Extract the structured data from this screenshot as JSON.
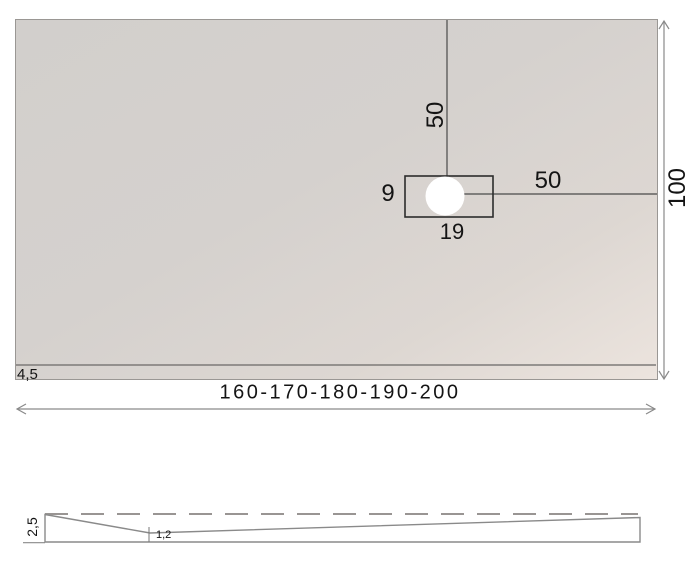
{
  "top_view": {
    "length_range_label": "160-170-180-190-200",
    "width_label": "100",
    "border_width_label": "4,5",
    "drain": {
      "distance_from_top_label": "50",
      "distance_from_right_label": "50",
      "recess_height_label": "9",
      "recess_width_label": "19"
    }
  },
  "side_view": {
    "edge_thickness_label": "2,5",
    "center_thickness_label": "1,2"
  },
  "colors": {
    "tray_fill_light": "#d2cfcc",
    "tray_fill_warm": "#ece4de",
    "dimension_line": "#8a8a8a",
    "drawing_line": "#4a4a4a",
    "text": "#141414"
  }
}
